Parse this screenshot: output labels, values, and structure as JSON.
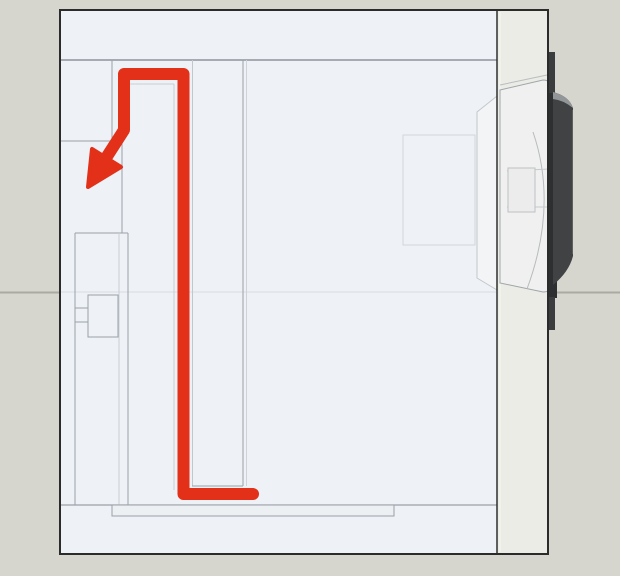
{
  "meta": {
    "title": "speaker-cabinet-cross-section-diagram",
    "canvas": {
      "width": 620,
      "height": 576
    }
  },
  "palette": {
    "background": "#d6d6ce",
    "background_wall_line": "#aaaaa2",
    "cabinet_interior": "#eef1f5",
    "baffle_fill": "#eaece5",
    "panel_line": "#9aa1a9",
    "panel_line_faint": "#c9ced5",
    "outline_dark": "#2b2b2b",
    "airflow_red": "#e23019",
    "driver_dark": "#2d2f31",
    "magnet_gray": "#404244"
  },
  "scene": {
    "shapes": [
      {
        "tag": "rect",
        "name": "background",
        "interactable": false,
        "attrs": {
          "x": 0,
          "y": 0,
          "width": 620,
          "height": 576,
          "fill": "#d6d6ce"
        }
      },
      {
        "tag": "line",
        "name": "background-wall-line",
        "interactable": false,
        "attrs": {
          "x1": 0,
          "y1": 292.5,
          "x2": 620,
          "y2": 292.5,
          "stroke": "#aaaaa2",
          "stroke-width": 2
        }
      },
      {
        "tag": "rect",
        "name": "cabinet-interior",
        "interactable": false,
        "attrs": {
          "x": 60,
          "y": 10,
          "width": 488,
          "height": 544,
          "fill": "#eef1f5"
        }
      },
      {
        "tag": "line",
        "name": "interior-xray-wall-line",
        "interactable": false,
        "attrs": {
          "x1": 61,
          "y1": 292,
          "x2": 496,
          "y2": 292,
          "stroke": "#dfe3e8",
          "stroke-width": 1.5
        }
      },
      {
        "tag": "rect",
        "name": "magnet-xray-outline",
        "interactable": false,
        "attrs": {
          "x": 403,
          "y": 135,
          "width": 72,
          "height": 110,
          "fill": "none",
          "stroke": "#d2d6db",
          "stroke-width": 1
        }
      },
      {
        "tag": "path",
        "name": "driver-basket-xray",
        "interactable": false,
        "attrs": {
          "d": "M477,112 L497,96 L497,290 L477,278 Z",
          "fill": "#f2f4f6",
          "stroke": "#c3c8ce",
          "stroke-width": 1
        }
      },
      {
        "tag": "line",
        "name": "top-wall-inner-edge",
        "interactable": false,
        "attrs": {
          "x1": 60,
          "y1": 60,
          "x2": 497,
          "y2": 60,
          "stroke": "#8d939b",
          "stroke-width": 1.5
        }
      },
      {
        "tag": "line",
        "name": "bottom-wall-inner-edge",
        "interactable": false,
        "attrs": {
          "x1": 60,
          "y1": 505,
          "x2": 497,
          "y2": 505,
          "stroke": "#9aa1a9",
          "stroke-width": 1.2
        }
      },
      {
        "tag": "line",
        "name": "port-block-right-edge",
        "interactable": false,
        "attrs": {
          "x1": 112,
          "y1": 60,
          "x2": 112,
          "y2": 141,
          "stroke": "#9aa1a9",
          "stroke-width": 1
        }
      },
      {
        "tag": "line",
        "name": "port-block-bottom-edge",
        "interactable": false,
        "attrs": {
          "x1": 60,
          "y1": 141,
          "x2": 112,
          "y2": 141,
          "stroke": "#9aa1a9",
          "stroke-width": 1
        }
      },
      {
        "tag": "line",
        "name": "port-duct-wall",
        "interactable": false,
        "attrs": {
          "x1": 122,
          "y1": 141,
          "x2": 122,
          "y2": 233,
          "stroke": "#9aa1a9",
          "stroke-width": 1
        }
      },
      {
        "tag": "line",
        "name": "left-inner-panel-edge",
        "interactable": false,
        "attrs": {
          "x1": 75,
          "y1": 233,
          "x2": 75,
          "y2": 505,
          "stroke": "#9aa1a9",
          "stroke-width": 1
        }
      },
      {
        "tag": "line",
        "name": "left-inner-panel-top",
        "interactable": false,
        "attrs": {
          "x1": 75,
          "y1": 233,
          "x2": 128,
          "y2": 233,
          "stroke": "#9aa1a9",
          "stroke-width": 1
        }
      },
      {
        "tag": "line",
        "name": "divider-a-left-faint",
        "interactable": false,
        "attrs": {
          "x1": 119,
          "y1": 233,
          "x2": 119,
          "y2": 505,
          "stroke": "#c9ced5",
          "stroke-width": 1
        }
      },
      {
        "tag": "line",
        "name": "divider-a-right-edge",
        "interactable": false,
        "attrs": {
          "x1": 128,
          "y1": 233,
          "x2": 128,
          "y2": 516,
          "stroke": "#9aa1a9",
          "stroke-width": 1
        }
      },
      {
        "tag": "line",
        "name": "divider-b-top-edge",
        "interactable": false,
        "attrs": {
          "x1": 130,
          "y1": 84,
          "x2": 174,
          "y2": 84,
          "stroke": "#c9ced5",
          "stroke-width": 1
        }
      },
      {
        "tag": "line",
        "name": "divider-b-right-edge",
        "interactable": false,
        "attrs": {
          "x1": 174,
          "y1": 84,
          "x2": 174,
          "y2": 490,
          "stroke": "#c9ced5",
          "stroke-width": 1
        }
      },
      {
        "tag": "line",
        "name": "duct-panel-left-edge",
        "interactable": false,
        "attrs": {
          "x1": 192.5,
          "y1": 60,
          "x2": 192.5,
          "y2": 486,
          "stroke": "#c2c7cd",
          "stroke-width": 1
        }
      },
      {
        "tag": "line",
        "name": "duct-panel-right-edge",
        "interactable": false,
        "attrs": {
          "x1": 243,
          "y1": 60,
          "x2": 243,
          "y2": 486,
          "stroke": "#9aa1a9",
          "stroke-width": 1
        }
      },
      {
        "tag": "line",
        "name": "duct-panel-right-faint",
        "interactable": false,
        "attrs": {
          "x1": 246.5,
          "y1": 60,
          "x2": 246.5,
          "y2": 486,
          "stroke": "#ced3d9",
          "stroke-width": 1
        }
      },
      {
        "tag": "line",
        "name": "duct-panel-bottom-edge",
        "interactable": false,
        "attrs": {
          "x1": 192,
          "y1": 486,
          "x2": 243,
          "y2": 486,
          "stroke": "#9aa1a9",
          "stroke-width": 1
        }
      },
      {
        "tag": "rect",
        "name": "crossover-block",
        "interactable": false,
        "attrs": {
          "x": 88,
          "y": 295,
          "width": 30,
          "height": 42,
          "fill": "#eef1f5",
          "stroke": "#9aa1a9",
          "stroke-width": 1
        }
      },
      {
        "tag": "line",
        "name": "crossover-tab-top",
        "interactable": false,
        "attrs": {
          "x1": 75,
          "y1": 308,
          "x2": 88,
          "y2": 308,
          "stroke": "#9aa1a9",
          "stroke-width": 1
        }
      },
      {
        "tag": "line",
        "name": "crossover-tab-bottom",
        "interactable": false,
        "attrs": {
          "x1": 75,
          "y1": 322,
          "x2": 88,
          "y2": 322,
          "stroke": "#9aa1a9",
          "stroke-width": 1
        }
      },
      {
        "tag": "rect",
        "name": "bottom-spacer-board",
        "interactable": false,
        "attrs": {
          "x": 112,
          "y": 505,
          "width": 282,
          "height": 11,
          "fill": "#edf0f3",
          "stroke": "#9aa1a9",
          "stroke-width": 1
        }
      },
      {
        "tag": "polyline",
        "name": "airflow-path",
        "interactable": false,
        "attrs": {
          "points": "253,494 183.5,494 183.5,74 124,74 124,130 106,158",
          "fill": "none",
          "stroke": "#e23019",
          "stroke-width": 12,
          "stroke-linecap": "round",
          "stroke-linejoin": "round"
        }
      },
      {
        "tag": "polygon",
        "name": "airflow-arrowhead",
        "interactable": false,
        "attrs": {
          "points": "121,167 92,149 88,187",
          "fill": "#e23019",
          "stroke": "#e23019",
          "stroke-width": 4,
          "stroke-linejoin": "round"
        }
      },
      {
        "tag": "rect",
        "name": "front-baffle",
        "interactable": false,
        "attrs": {
          "x": 497,
          "y": 10,
          "width": 51,
          "height": 544,
          "fill": "#eaece5",
          "stroke": "#2f2f2f",
          "stroke-width": 1.5
        }
      },
      {
        "tag": "line",
        "name": "baffle-highlight",
        "interactable": false,
        "attrs": {
          "x1": 500,
          "y1": 12,
          "x2": 500,
          "y2": 552,
          "stroke": "#f2f3ee",
          "stroke-width": 1.5
        }
      },
      {
        "tag": "line",
        "name": "driver-frame-top-edge",
        "interactable": false,
        "attrs": {
          "x1": 500,
          "y1": 85,
          "x2": 547,
          "y2": 75,
          "stroke": "#b9bdc1",
          "stroke-width": 1
        }
      },
      {
        "tag": "path",
        "name": "driver-body",
        "interactable": false,
        "attrs": {
          "d": "M500,90 L543,80 Q551,80 551,88 L551,285 Q551,292 543,292 L500,283 Z",
          "fill": "#eff0ef",
          "stroke": "#a0a5aa",
          "stroke-width": 1
        }
      },
      {
        "tag": "path",
        "name": "driver-cone-curve",
        "interactable": false,
        "attrs": {
          "d": "M533,132 Q558,205 527,289",
          "fill": "none",
          "stroke": "#b7bbbf",
          "stroke-width": 1
        }
      },
      {
        "tag": "line",
        "name": "driver-spider-line-top",
        "interactable": false,
        "attrs": {
          "x1": 507,
          "y1": 171,
          "x2": 549,
          "y2": 169,
          "stroke": "#c6cacd",
          "stroke-width": 1
        }
      },
      {
        "tag": "line",
        "name": "driver-spider-line-bottom",
        "interactable": false,
        "attrs": {
          "x1": 507,
          "y1": 207,
          "x2": 549,
          "y2": 207,
          "stroke": "#c6cacd",
          "stroke-width": 1
        }
      },
      {
        "tag": "rect",
        "name": "voice-coil-block",
        "interactable": false,
        "attrs": {
          "x": 508,
          "y": 168,
          "width": 27,
          "height": 44,
          "fill": "#ececec",
          "stroke": "#bdc1c5",
          "stroke-width": 1
        }
      },
      {
        "tag": "rect",
        "name": "driver-flange-top-tab",
        "interactable": false,
        "attrs": {
          "x": 549,
          "y": 52,
          "width": 6,
          "height": 45,
          "fill": "#3a3c3e"
        }
      },
      {
        "tag": "rect",
        "name": "driver-flange-main",
        "interactable": false,
        "attrs": {
          "x": 547,
          "y": 93,
          "width": 10,
          "height": 205,
          "fill": "#2d2f31"
        }
      },
      {
        "tag": "rect",
        "name": "driver-flange-bottom-tab",
        "interactable": false,
        "attrs": {
          "x": 549,
          "y": 297,
          "width": 6,
          "height": 33,
          "fill": "#3a3c3e"
        }
      },
      {
        "tag": "path",
        "name": "magnet-body",
        "interactable": false,
        "attrs": {
          "d": "M553,92 Q569,96 573,108 L573,256 Q569,272 553,285 Z",
          "fill": "#404244"
        }
      },
      {
        "tag": "path",
        "name": "magnet-top-cap",
        "interactable": false,
        "attrs": {
          "d": "M553,92 Q569,96 573,108 Q563,100 553,99 Z",
          "fill": "#939699"
        }
      },
      {
        "tag": "line",
        "name": "magnet-right-rim",
        "interactable": false,
        "attrs": {
          "x1": 572.5,
          "y1": 110,
          "x2": 572.5,
          "y2": 254,
          "stroke": "#5d5f61",
          "stroke-width": 1
        }
      },
      {
        "tag": "rect",
        "name": "cabinet-outline",
        "interactable": false,
        "attrs": {
          "x": 60,
          "y": 10,
          "width": 488,
          "height": 544,
          "fill": "none",
          "stroke": "#2b2b2b",
          "stroke-width": 2
        }
      }
    ]
  }
}
